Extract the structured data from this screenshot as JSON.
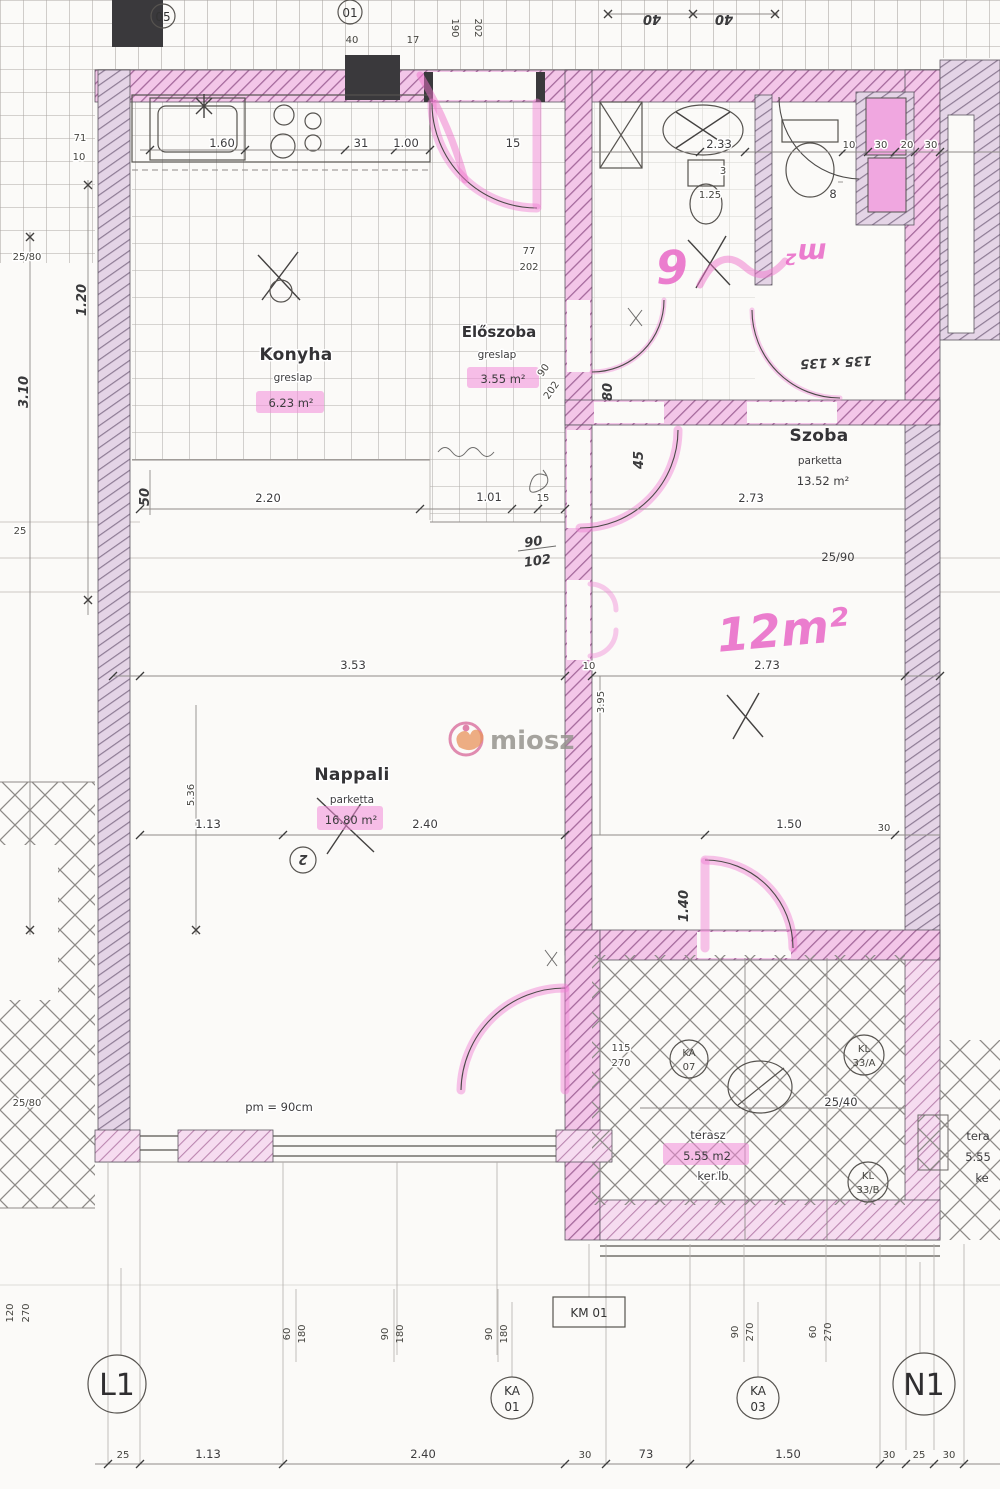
{
  "watermark": {
    "brand": "miosz"
  },
  "rooms": {
    "konyha": {
      "name": "Konyha",
      "floor": "greslap",
      "area": "6.23 m²"
    },
    "eloszoba": {
      "name": "Előszoba",
      "floor": "greslap",
      "area": "3.55 m²"
    },
    "szoba": {
      "name": "Szoba",
      "floor": "parketta",
      "area": "13.52 m²"
    },
    "nappali": {
      "name": "Nappali",
      "floor": "parketta",
      "area": "16.80 m²"
    },
    "terasz": {
      "name": "terasz",
      "area": "5.55 m2",
      "floor": "ker.lb"
    },
    "neighbor_terasz": {
      "name": "tera",
      "area": "5.55",
      "floor": "ke"
    }
  },
  "handwritten": {
    "szoba_area": "12m²",
    "bath_digit": "6",
    "bath_unit": "m²",
    "top_left_40": "40",
    "top_right_40": "40",
    "window_size": "135 x 135",
    "hall_90": "90",
    "hall_102": "102",
    "door_80": "80",
    "door_45": "45",
    "door_140": "1.40",
    "dim_310": "3.10",
    "dim_120": "1.20",
    "dim_50": "50",
    "circle_2": "2"
  },
  "markers": {
    "c05": "05",
    "c01": "01",
    "l1": "L1",
    "n1": "N1",
    "ka": "KA",
    "ka01": "01",
    "ka03": "03",
    "ka07": "07",
    "kl": "KL",
    "kl33a": "33/A",
    "kl33b": "33/B",
    "km01": "KM 01"
  },
  "dims": {
    "left": {
      "a2580": "25/80",
      "v25": "25",
      "b2580": "25/80",
      "v120": "120",
      "v270": "270",
      "w71": "71",
      "w10": "10"
    },
    "kitchen": {
      "sink": "1.60",
      "hob": "31",
      "hob2": "1.00",
      "gap": "15",
      "p40": "40",
      "p17": "17",
      "v190": "190",
      "v202": "202",
      "w220": "2.20",
      "w101": "1.01",
      "w15": "15"
    },
    "bath": {
      "w233": "2.33",
      "h3": "3",
      "h125": "1.25",
      "v8": "8",
      "t10": "10",
      "t30a": "30",
      "t20": "20",
      "t30b": "30"
    },
    "szoba": {
      "win": "25/90",
      "w273a": "2.73",
      "w273b": "2.73",
      "t10": "10",
      "v395": "3.95"
    },
    "doors": {
      "d77": "77",
      "d202": "202",
      "e90": "90",
      "e202": "202"
    },
    "nappali": {
      "w353": "3.53",
      "v536": "5.36",
      "w113": "1.13",
      "w240": "2.40",
      "pm": "pm = 90cm"
    },
    "terasz": {
      "w150": "1.50",
      "t30": "30",
      "s115": "115",
      "s270": "270",
      "w2540": "25/40"
    },
    "schedule": {
      "a60": "60",
      "a180": "180",
      "b90": "90",
      "b180": "180",
      "c90": "90",
      "c180": "180",
      "d90": "90",
      "d270": "270",
      "e60": "60",
      "e270": "270"
    },
    "base": {
      "b25a": "25",
      "b113": "1.13",
      "b240": "2.40",
      "b30a": "30",
      "b73": "73",
      "b150": "1.50",
      "b30b": "30",
      "b25b": "25",
      "b30c": "30"
    }
  }
}
